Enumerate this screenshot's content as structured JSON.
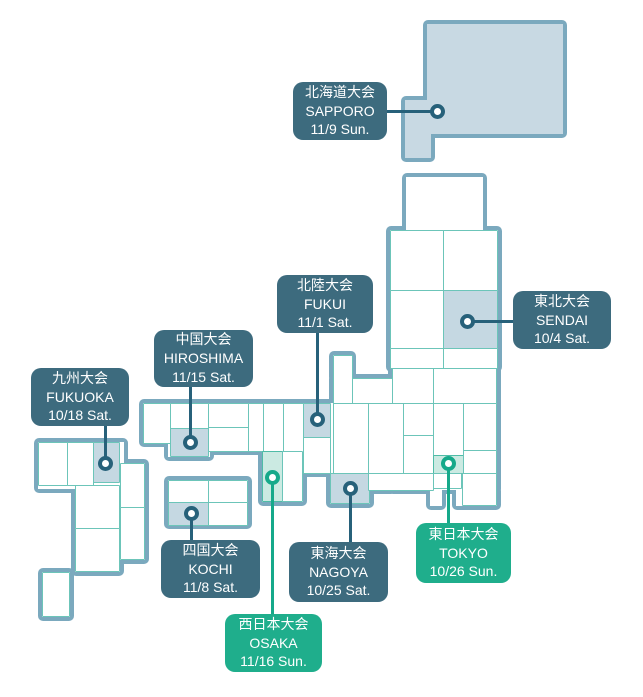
{
  "title": "Japan regional tournament map",
  "colors": {
    "label_dark": "#3D6B7E",
    "label_green": "#1FAE8C",
    "label_text": "#FFFFFF",
    "land_border": "#7BA9BE",
    "land_fill": "#FFFFFF",
    "hokkaido_fill": "#C8D9E3",
    "cell_border": "#6CC5B9",
    "highlight_blue": "#C5D8E2",
    "highlight_green": "#CBEAE2",
    "pin_dark": "#27617A",
    "pin_green": "#16A98A"
  },
  "events": [
    {
      "region_jp": "北海道大会",
      "city": "SAPPORO",
      "date": "11/9 Sun.",
      "variant": "dark"
    },
    {
      "region_jp": "東北大会",
      "city": "SENDAI",
      "date": "10/4 Sat.",
      "variant": "dark"
    },
    {
      "region_jp": "北陸大会",
      "city": "FUKUI",
      "date": "11/1 Sat.",
      "variant": "dark"
    },
    {
      "region_jp": "中国大会",
      "city": "HIROSHIMA",
      "date": "11/15 Sat.",
      "variant": "dark"
    },
    {
      "region_jp": "九州大会",
      "city": "FUKUOKA",
      "date": "10/18 Sat.",
      "variant": "dark"
    },
    {
      "region_jp": "四国大会",
      "city": "KOCHI",
      "date": "11/8 Sat.",
      "variant": "dark"
    },
    {
      "region_jp": "東海大会",
      "city": "NAGOYA",
      "date": "10/25 Sat.",
      "variant": "dark"
    },
    {
      "region_jp": "西日本大会",
      "city": "OSAKA",
      "date": "11/16 Sun.",
      "variant": "green"
    },
    {
      "region_jp": "東日本大会",
      "city": "TOKYO",
      "date": "10/26 Sun.",
      "variant": "green"
    }
  ]
}
